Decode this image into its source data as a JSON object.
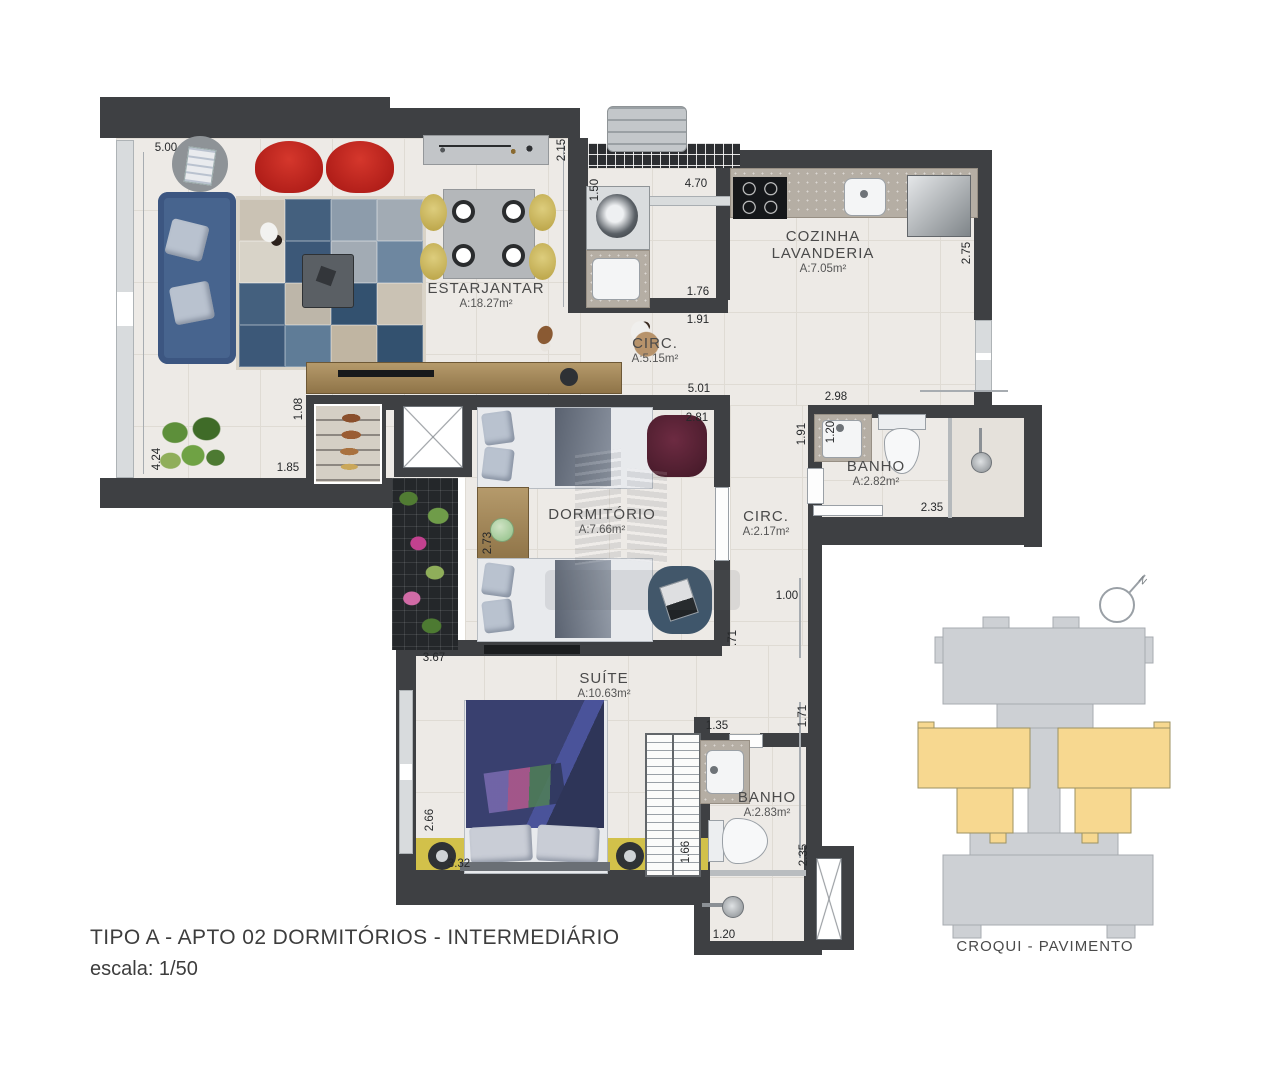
{
  "title": {
    "line1": "TIPO A - APTO 02  DORMITÓRIOS - INTERMEDIÁRIO",
    "line2": "escala: 1/50"
  },
  "croqui": {
    "label": "CROQUI - PAVIMENTO",
    "north": "N",
    "building_color": "#cdd0d4",
    "highlight_color": "#f7d890"
  },
  "colors": {
    "wall": "#3e4043",
    "floor": "#edeae6",
    "accent_yellow_wall": "#d2c14a",
    "sofa_blue": "#47648e",
    "chair_red": "#c1261f"
  },
  "rooms": [
    {
      "lines": [
        "ESTARJANTAR"
      ],
      "area": "A:18.27m²",
      "x": 486,
      "y": 280
    },
    {
      "lines": [
        "COZINHA",
        "LAVANDERIA"
      ],
      "area": "A:7.05m²",
      "x": 823,
      "y": 228
    },
    {
      "lines": [
        "CIRC."
      ],
      "area": "A:5.15m²",
      "x": 655,
      "y": 335
    },
    {
      "lines": [
        "DORMITÓRIO"
      ],
      "area": "A:7.66m²",
      "x": 602,
      "y": 506
    },
    {
      "lines": [
        "CIRC."
      ],
      "area": "A:2.17m²",
      "x": 766,
      "y": 508
    },
    {
      "lines": [
        "BANHO"
      ],
      "area": "A:2.82m²",
      "x": 876,
      "y": 458
    },
    {
      "lines": [
        "SUÍTE"
      ],
      "area": "A:10.63m²",
      "x": 604,
      "y": 670
    },
    {
      "lines": [
        "BANHO"
      ],
      "area": "A:2.83m²",
      "x": 767,
      "y": 789
    }
  ],
  "dimensions": [
    {
      "v": "5.00",
      "x": 166,
      "y": 148,
      "r": 0
    },
    {
      "v": "2.15",
      "x": 562,
      "y": 150,
      "r": 1
    },
    {
      "v": "1.50",
      "x": 595,
      "y": 190,
      "r": 1
    },
    {
      "v": "4.70",
      "x": 696,
      "y": 184,
      "r": 0
    },
    {
      "v": "1.76",
      "x": 698,
      "y": 292,
      "r": 0
    },
    {
      "v": "1.91",
      "x": 698,
      "y": 320,
      "r": 0
    },
    {
      "v": "2.75",
      "x": 967,
      "y": 253,
      "r": 1
    },
    {
      "v": "5.01",
      "x": 699,
      "y": 389,
      "r": 0
    },
    {
      "v": "2.98",
      "x": 836,
      "y": 397,
      "r": 0
    },
    {
      "v": "2.81",
      "x": 697,
      "y": 418,
      "r": 0
    },
    {
      "v": "1.91",
      "x": 802,
      "y": 434,
      "r": 1
    },
    {
      "v": "1.20",
      "x": 831,
      "y": 432,
      "r": 1
    },
    {
      "v": "2.35",
      "x": 932,
      "y": 508,
      "r": 0
    },
    {
      "v": "1.08",
      "x": 299,
      "y": 409,
      "r": 1
    },
    {
      "v": "1.85",
      "x": 288,
      "y": 468,
      "r": 0
    },
    {
      "v": "4.24",
      "x": 157,
      "y": 459,
      "r": 1
    },
    {
      "v": "2.73",
      "x": 488,
      "y": 543,
      "r": 1
    },
    {
      "v": "1.00",
      "x": 787,
      "y": 596,
      "r": 0
    },
    {
      "v": ".71",
      "x": 733,
      "y": 638,
      "r": 1
    },
    {
      "v": "3.67",
      "x": 434,
      "y": 658,
      "r": 0
    },
    {
      "v": "1.35",
      "x": 717,
      "y": 726,
      "r": 0
    },
    {
      "v": "1.71",
      "x": 803,
      "y": 716,
      "r": 1
    },
    {
      "v": "2.66",
      "x": 430,
      "y": 820,
      "r": 1
    },
    {
      "v": "3.32",
      "x": 459,
      "y": 864,
      "r": 0
    },
    {
      "v": "1.66",
      "x": 686,
      "y": 852,
      "r": 1
    },
    {
      "v": "2.35",
      "x": 804,
      "y": 855,
      "r": 1
    },
    {
      "v": "1.20",
      "x": 724,
      "y": 935,
      "r": 0
    }
  ]
}
